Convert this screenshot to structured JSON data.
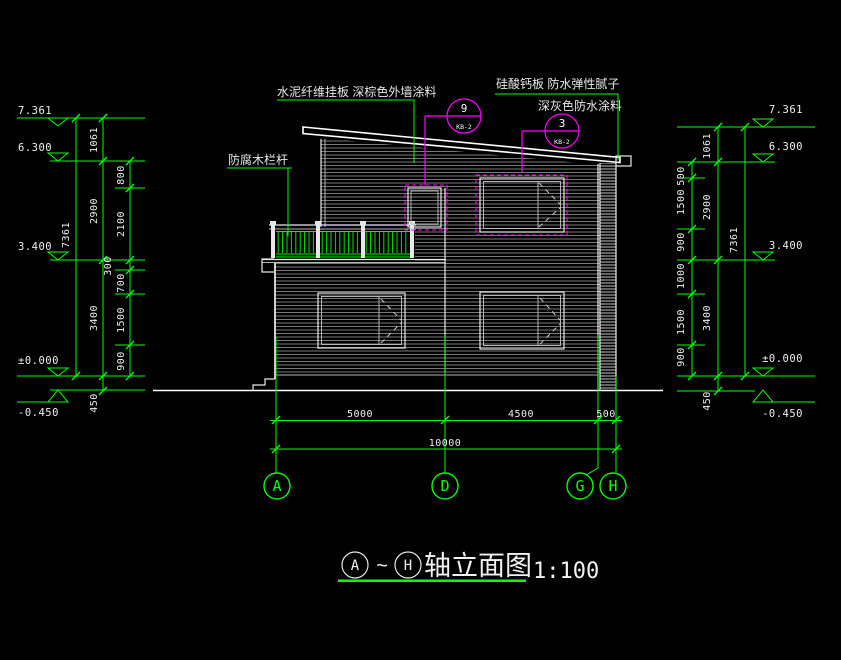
{
  "title": {
    "axis_start": "A",
    "separator": "~",
    "axis_end": "H",
    "name": "轴立面图",
    "scale": "1:100"
  },
  "annotations": {
    "siding": "水泥纤维挂板  深棕色外墙涂料",
    "railing": "防腐木栏杆",
    "board": "硅酸钙板  防水弹性腻子",
    "coating": "深灰色防水涂料"
  },
  "callouts": {
    "c9": {
      "num": "9",
      "ref": "KB-2"
    },
    "c3": {
      "num": "3",
      "ref": "KB-2"
    }
  },
  "levels": {
    "top": "7.361",
    "second": "6.300",
    "floor2": "3.400",
    "zero": "±0.000",
    "ground": "-0.450"
  },
  "dims": {
    "left": {
      "overall": "7361",
      "floors": [
        "1061",
        "2900",
        "3400",
        "450"
      ],
      "details": [
        "800",
        "2100",
        "300",
        "700",
        "1500",
        "900"
      ]
    },
    "right": {
      "overall": "7361",
      "floors": [
        "1061",
        "2900",
        "3400",
        "450"
      ],
      "details": [
        "500",
        "1500",
        "900",
        "1000",
        "1500",
        "900"
      ]
    },
    "bottom": {
      "segments": [
        "5000",
        "4500",
        "500"
      ],
      "total": "10000"
    }
  },
  "axes": {
    "a": "A",
    "d": "D",
    "g": "G",
    "h": "H"
  },
  "colors": {
    "background": "#000000",
    "dimension_green": "#00ff00",
    "outline_white": "#ffffff",
    "callout_magenta": "#ff00ff",
    "siding_hatch": "#787878"
  }
}
